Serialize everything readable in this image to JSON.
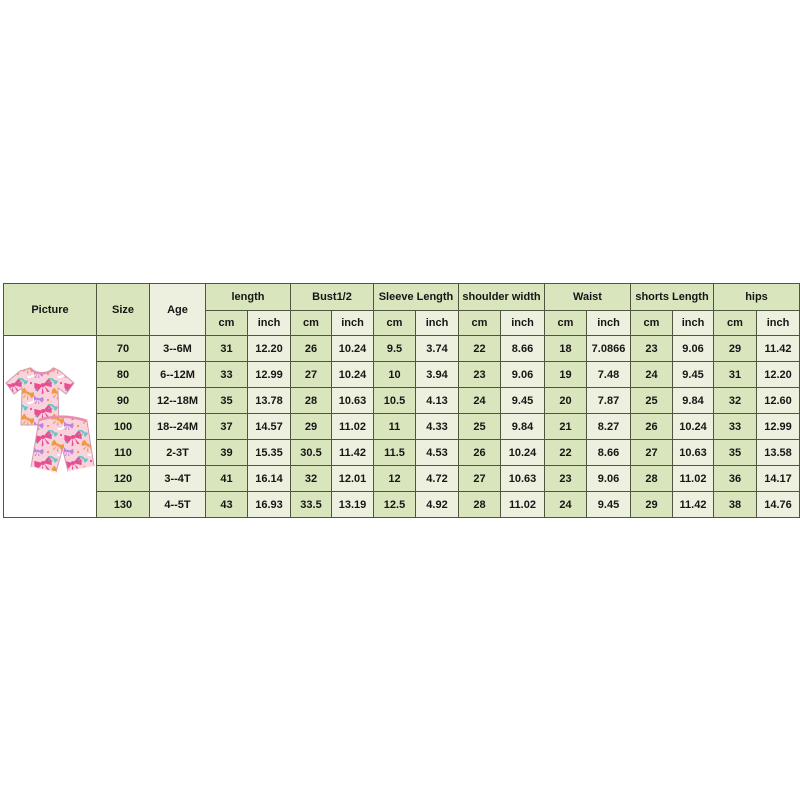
{
  "page": {
    "background": "#ffffff"
  },
  "table": {
    "headers": {
      "picture": "Picture",
      "size": "Size",
      "age": "Age",
      "unit_cm": "cm",
      "unit_inch": "inch",
      "groups": [
        "length",
        "Bust1/2",
        "Sleeve Length",
        "shoulder width",
        "Waist",
        "shorts Length",
        "hips"
      ]
    },
    "rows": [
      {
        "size": "70",
        "age": "3--6M",
        "values": [
          "31",
          "12.20",
          "26",
          "10.24",
          "9.5",
          "3.74",
          "22",
          "8.66",
          "18",
          "7.0866",
          "23",
          "9.06",
          "29",
          "11.42"
        ]
      },
      {
        "size": "80",
        "age": "6--12M",
        "values": [
          "33",
          "12.99",
          "27",
          "10.24",
          "10",
          "3.94",
          "23",
          "9.06",
          "19",
          "7.48",
          "24",
          "9.45",
          "31",
          "12.20"
        ]
      },
      {
        "size": "90",
        "age": "12--18M",
        "values": [
          "35",
          "13.78",
          "28",
          "10.63",
          "10.5",
          "4.13",
          "24",
          "9.45",
          "20",
          "7.87",
          "25",
          "9.84",
          "32",
          "12.60"
        ]
      },
      {
        "size": "100",
        "age": "18--24M",
        "values": [
          "37",
          "14.57",
          "29",
          "11.02",
          "11",
          "4.33",
          "25",
          "9.84",
          "21",
          "8.27",
          "26",
          "10.24",
          "33",
          "12.99"
        ]
      },
      {
        "size": "110",
        "age": "2-3T",
        "values": [
          "39",
          "15.35",
          "30.5",
          "11.42",
          "11.5",
          "4.53",
          "26",
          "10.24",
          "22",
          "8.66",
          "27",
          "10.63",
          "35",
          "13.58"
        ]
      },
      {
        "size": "120",
        "age": "3--4T",
        "values": [
          "41",
          "16.14",
          "32",
          "12.01",
          "12",
          "4.72",
          "27",
          "10.63",
          "23",
          "9.06",
          "28",
          "11.02",
          "36",
          "14.17"
        ]
      },
      {
        "size": "130",
        "age": "4--5T",
        "values": [
          "43",
          "16.93",
          "33.5",
          "13.19",
          "12.5",
          "4.92",
          "28",
          "11.02",
          "24",
          "9.45",
          "29",
          "11.42",
          "38",
          "14.76"
        ]
      }
    ]
  },
  "picture": {
    "description": "pink bow-print short-sleeve tee and matching shorts set",
    "colors": {
      "fabric_base": "#f9d2de",
      "bow_pink": "#e84e92",
      "bow_orange": "#f09a3e",
      "bow_purple": "#bd85d8",
      "bow_teal": "#6ec4bf",
      "trim": "#e3a8bf"
    }
  },
  "colors": {
    "cell_green": "#d9e5bd",
    "cell_cream": "#eef0df",
    "border": "#50553f"
  }
}
